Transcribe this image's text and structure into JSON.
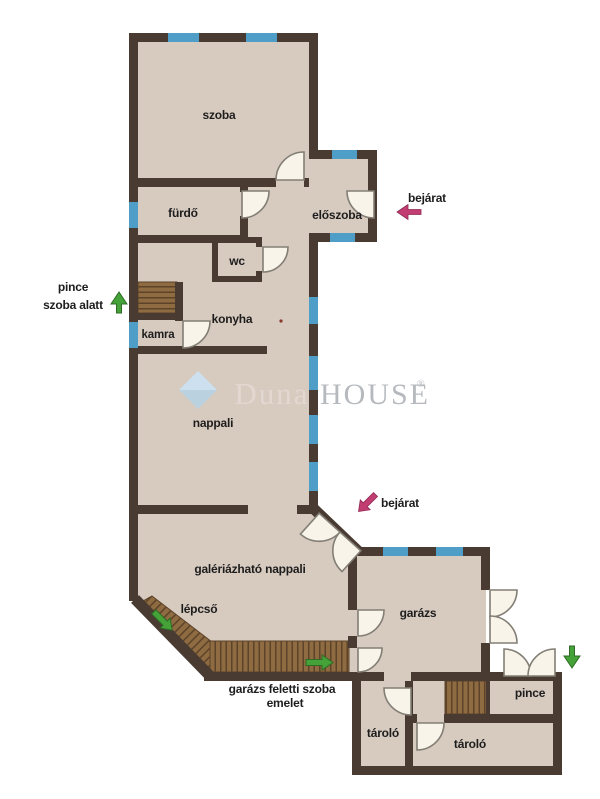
{
  "labels": {
    "szoba": "szoba",
    "furdo": "fürdő",
    "eloszoba": "előszoba",
    "wc": "wc",
    "konyha": "konyha",
    "kamra": "kamra",
    "nappali": "nappali",
    "galeria_nappali": "galériázható nappali",
    "lepcso": "lépcső",
    "garazs": "garázs",
    "pince_room": "pince",
    "tarolo_left": "tároló",
    "tarolo_right": "tároló",
    "bejarat_upper": "bejárat",
    "bejarat_lower": "bejárat",
    "pince_note_line1": "pince",
    "pince_note_line2": "szoba alatt",
    "garazs_note_line1": "garázs feletti szoba",
    "garazs_note_line2": "emelet"
  },
  "watermark": {
    "prefix": "Duna",
    "name": "HOUSE",
    "reg": "®"
  },
  "colors": {
    "wall": "#4a3b32",
    "floor": "#d7cabf",
    "window": "#4f9ec8",
    "stair": "#8e6b41",
    "stair_stripe": "#5d4329",
    "door_fill": "#f8f4ea",
    "door_stroke": "#827e75",
    "green_arrow": "#44a238",
    "pink_arrow": "#c23e72",
    "text": "#1d1d1d",
    "watermark_gray": "#b6b9bd",
    "watermark_blue": "#b3d3e9",
    "watermark_blue_light": "#cfe3f2"
  }
}
